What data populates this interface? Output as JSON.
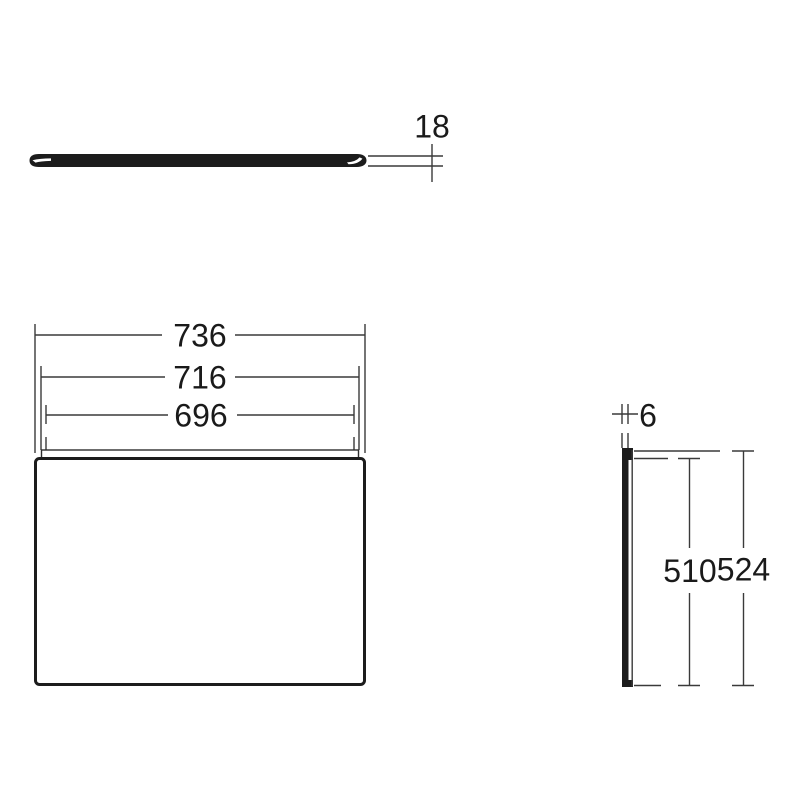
{
  "canvas": {
    "width": 800,
    "height": 800,
    "background": "#ffffff"
  },
  "colors": {
    "thin_line": "#3a3a3a",
    "thick_line": "#1c1c1c",
    "text": "#1a1a1a"
  },
  "drawing": {
    "kind": "technical-dimension-drawing",
    "views": {
      "top": {
        "description": "panel edge (thickness) view",
        "thickness_label": "18"
      },
      "front": {
        "description": "panel front view",
        "width_outer_label": "736",
        "width_mid_label": "716",
        "width_inner_label": "696"
      },
      "side": {
        "description": "panel side view",
        "thickness_label": "6",
        "height_inner_label": "510",
        "height_outer_label": "524"
      }
    }
  }
}
